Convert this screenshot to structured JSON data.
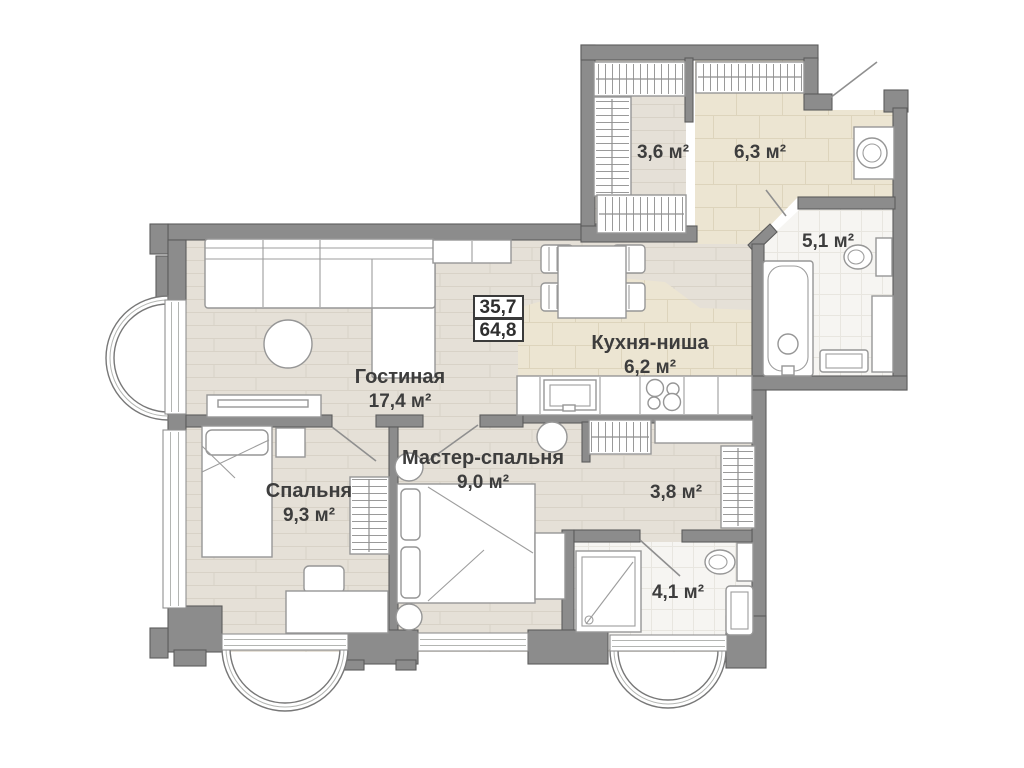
{
  "stamp": {
    "upper": "35,7",
    "lower": "64,8"
  },
  "rooms": {
    "living": {
      "name": "Гостиная",
      "area": "17,4 м²"
    },
    "bedroom": {
      "name": "Спальня",
      "area": "9,3 м²"
    },
    "master_bedroom": {
      "name": "Мастер-спальня",
      "area": "9,0 м²"
    },
    "kitchen": {
      "name": "Кухня-ниша",
      "area": "6,2 м²"
    },
    "wardrobe": {
      "area": "3,6 м²"
    },
    "hallway": {
      "area": "6,3 м²"
    },
    "bathroom_main": {
      "area": "5,1 м²"
    },
    "corridor": {
      "area": "3,8 м²"
    },
    "bathroom_ensuite": {
      "area": "4,1 м²"
    }
  },
  "colors": {
    "wall": "#8c8c8c",
    "wall_outline": "#5c5c5c",
    "wood_floor": "#e5e0d7",
    "tile_floor": "#ece5d2",
    "bath_floor": "#f6f5f2",
    "furniture_outline": "#969696",
    "label_text": "#3d3d3d"
  }
}
